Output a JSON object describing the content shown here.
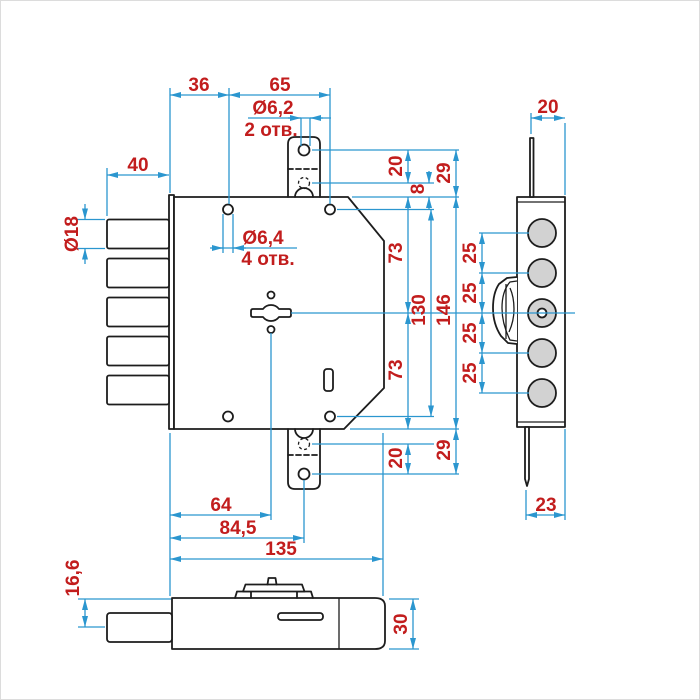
{
  "drawing": {
    "type": "technical-drawing",
    "subject": "mortise deadbolt lock, three projection views",
    "colors": {
      "outline": "#1d1d1d",
      "dimension_lines": "#2b96cf",
      "dimension_text": "#c21d1d",
      "bolt_fill": "#d2d2d2",
      "background": "#ffffff"
    },
    "dims": {
      "d36": "36",
      "d65": "65",
      "dia62": "Ø6,2",
      "otv2": "2 отв.",
      "d40": "40",
      "dia18": "Ø18",
      "dia64": "Ø6,4",
      "otv4": "4 отв.",
      "d20t": "20",
      "d8": "8",
      "d29t": "29",
      "d73a": "73",
      "d130": "130",
      "d146": "146",
      "d73b": "73",
      "d20b": "20",
      "d29b": "29",
      "d64": "64",
      "d845": "84,5",
      "d135": "135",
      "s20": "20",
      "s25a": "25",
      "s25b": "25",
      "s25c": "25",
      "s25d": "25",
      "s23": "23",
      "b166": "16,6",
      "b30": "30"
    }
  }
}
